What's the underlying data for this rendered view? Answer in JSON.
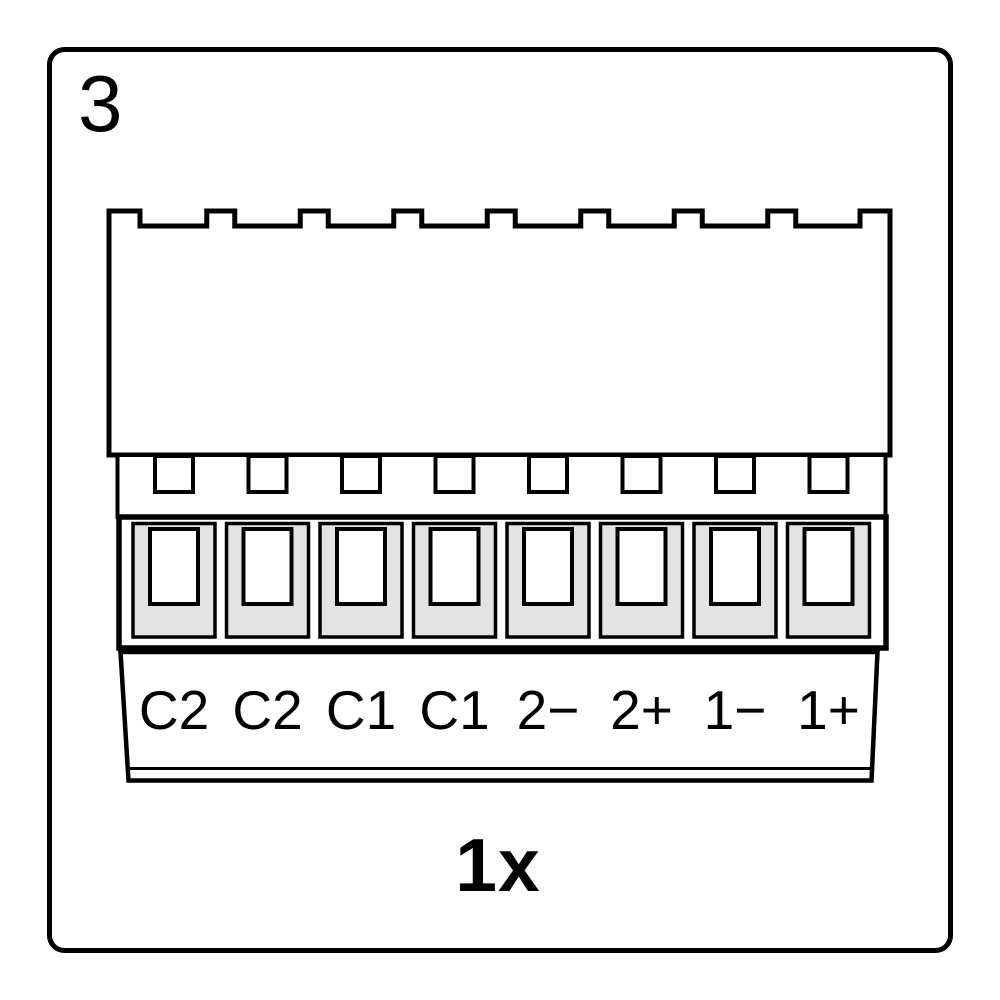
{
  "step_number": "3",
  "quantity_label": "1x",
  "connector": {
    "type": "8-pin terminal block connector",
    "pin_count": 8,
    "pins": [
      {
        "label": "C2"
      },
      {
        "label": "C2"
      },
      {
        "label": "C1"
      },
      {
        "label": "C1"
      },
      {
        "label": "2−"
      },
      {
        "label": "2+"
      },
      {
        "label": "1−"
      },
      {
        "label": "1+"
      }
    ]
  },
  "colors": {
    "outline": "#000000",
    "terminal_fill": "#e3e3e3",
    "background": "#ffffff"
  }
}
